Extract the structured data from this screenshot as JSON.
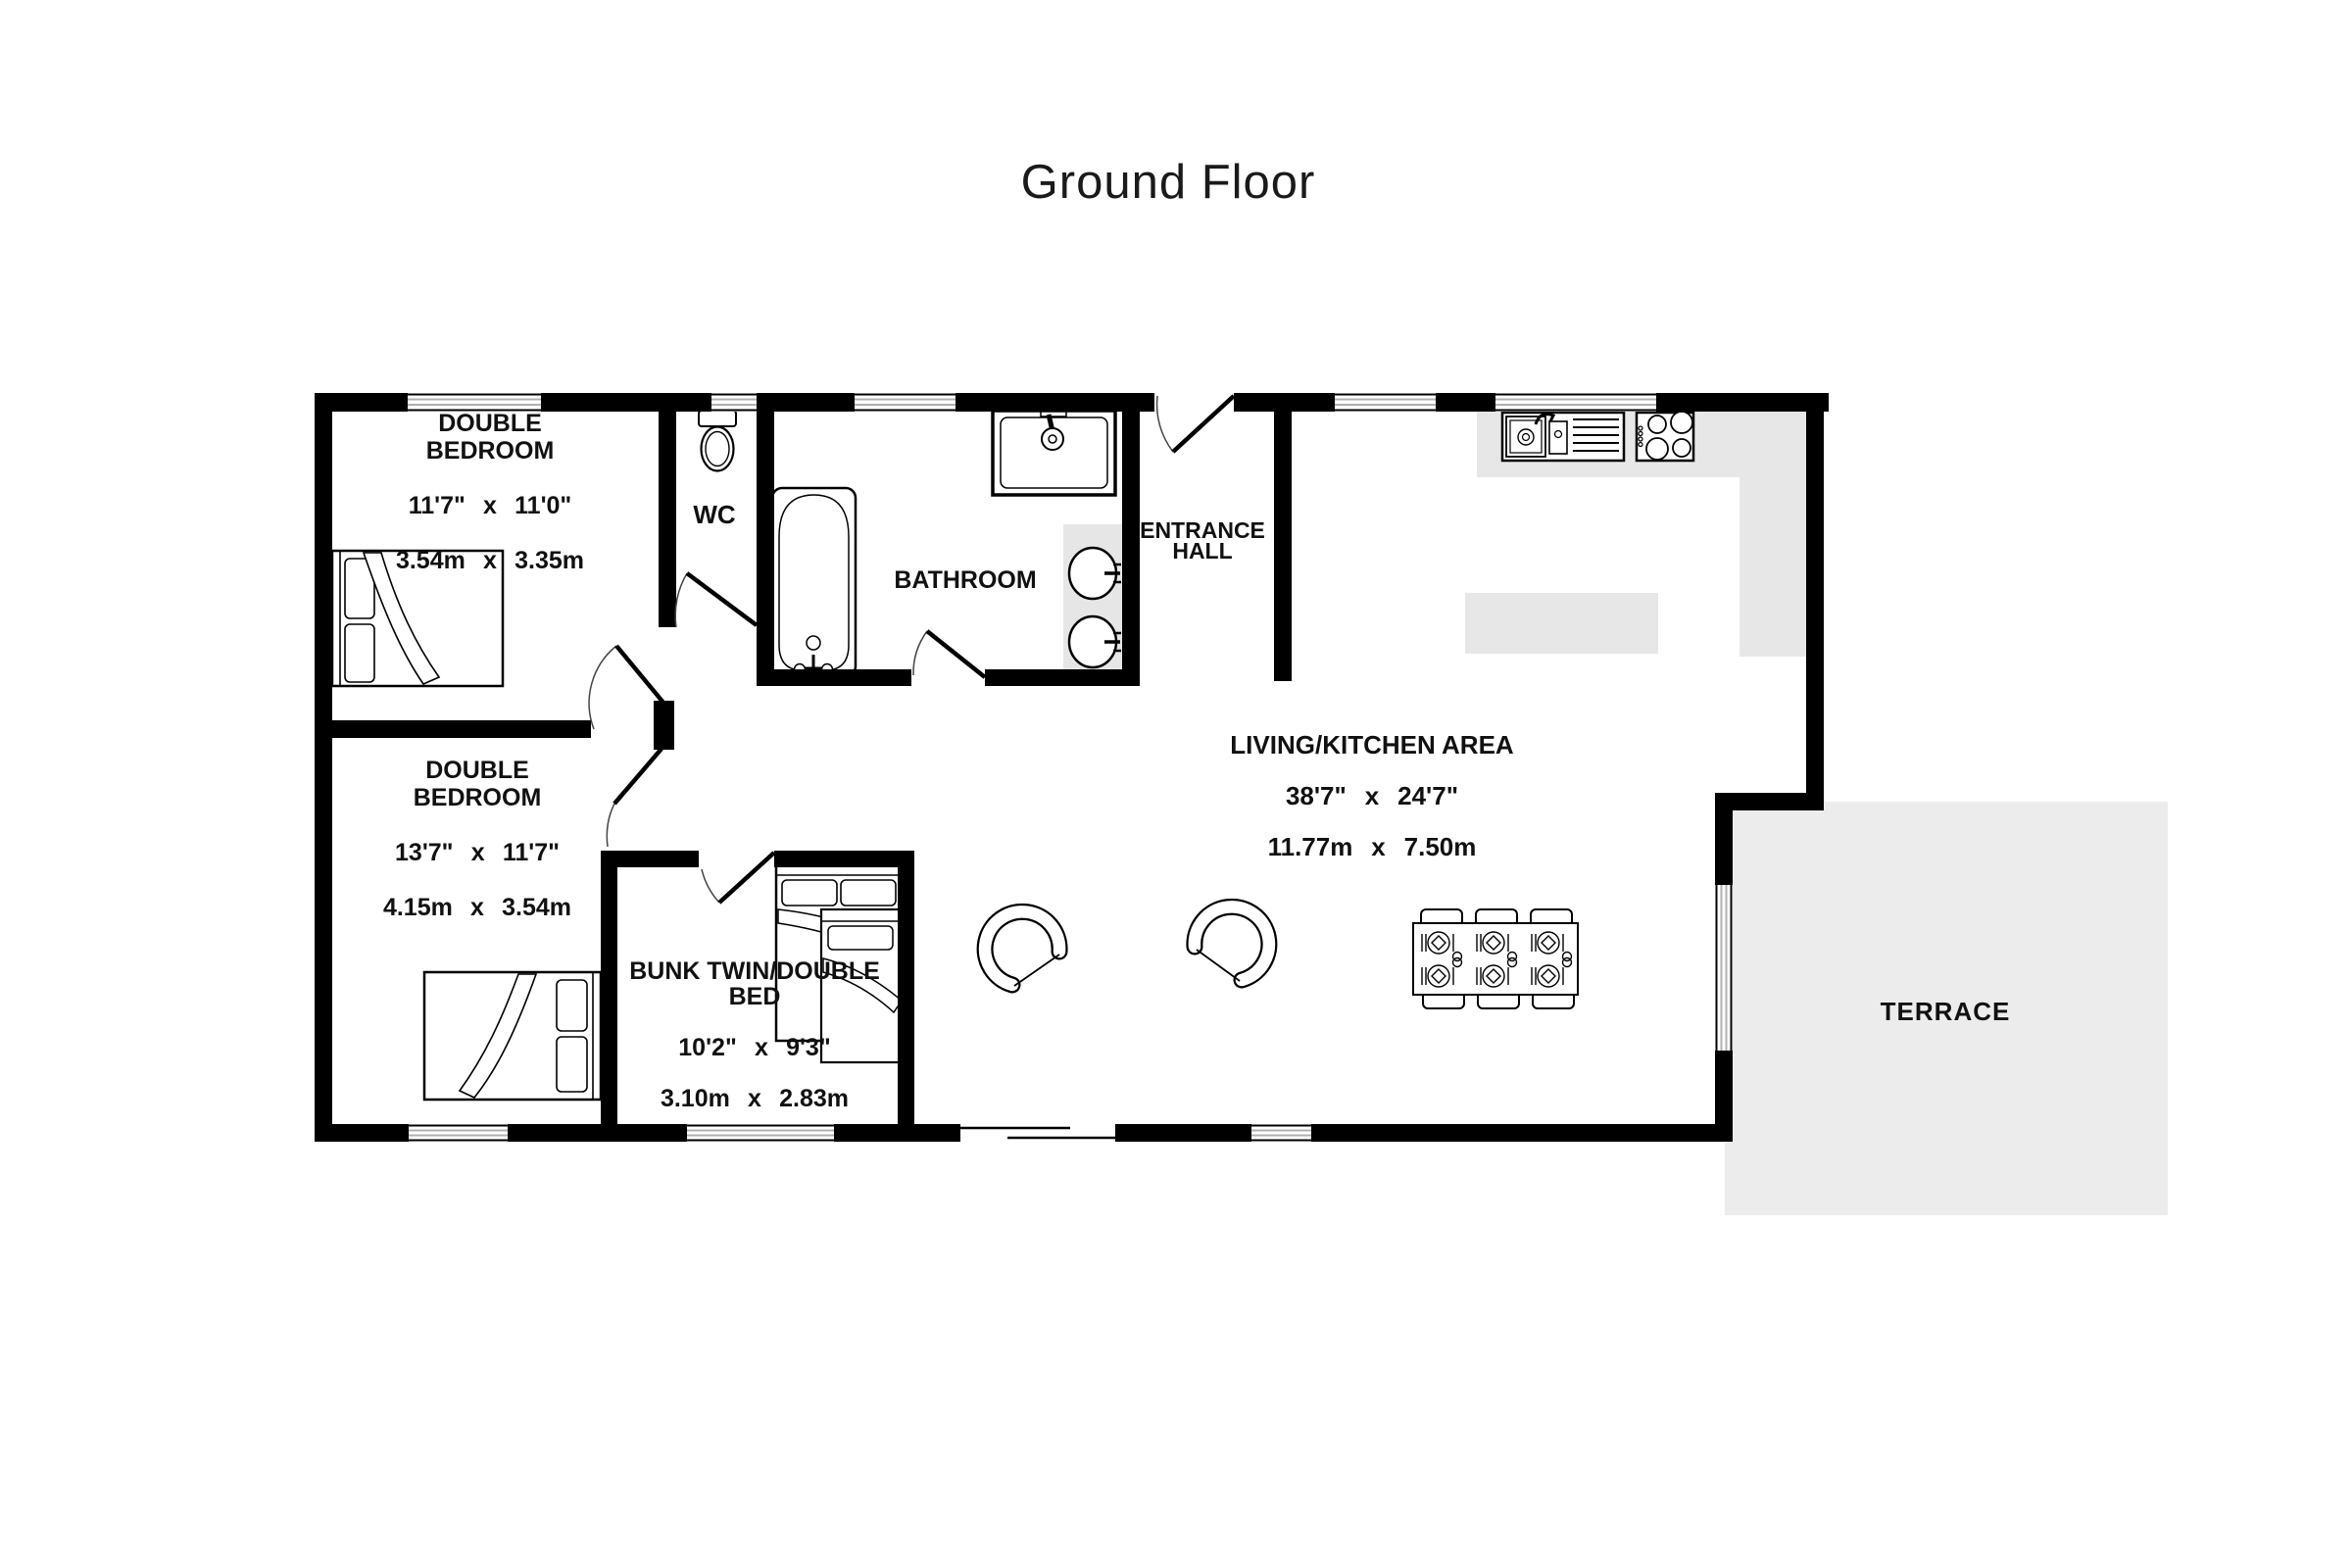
{
  "title": "Ground Floor",
  "rooms": {
    "double_bedroom_1": {
      "name": "DOUBLE\nBEDROOM",
      "dims_imperial": "11'7\" x 11'0\"",
      "dims_metric": "3.54m x 3.35m"
    },
    "wc": {
      "name": "WC"
    },
    "bathroom": {
      "name": "BATHROOM"
    },
    "entrance_hall": {
      "name": "ENTRANCE\nHALL"
    },
    "living_kitchen": {
      "name": "LIVING/KITCHEN AREA",
      "dims_imperial": "38'7\" x 24'7\"",
      "dims_metric": "11.77m x 7.50m"
    },
    "double_bedroom_2": {
      "name": "DOUBLE\nBEDROOM",
      "dims_imperial": "13'7\" x 11'7\"",
      "dims_metric": "4.15m x 3.54m"
    },
    "bunk_room": {
      "name": "BUNK TWIN/DOUBLE\nBED",
      "dims_imperial": "10'2\" x 9'3\"",
      "dims_metric": "3.10m x 2.83m"
    },
    "terrace": {
      "name": "TERRACE"
    }
  },
  "icons": [
    "toilet-icon",
    "bathtub-icon",
    "shower-icon",
    "bathroom-sink-icon",
    "kitchen-sink-icon",
    "hob-icon",
    "double-bed-icon",
    "bunk-bed-icon",
    "armchair-icon",
    "dining-table-icon",
    "dining-chair-icon",
    "place-setting-icon",
    "door-swing-icon",
    "window-icon"
  ],
  "colors": {
    "wall": "#000000",
    "floor": "#ffffff",
    "terrace_fill": "#ececec",
    "counter_fill": "#e7e7e7",
    "window_line": "#b0b0b0",
    "text": "#111111"
  }
}
